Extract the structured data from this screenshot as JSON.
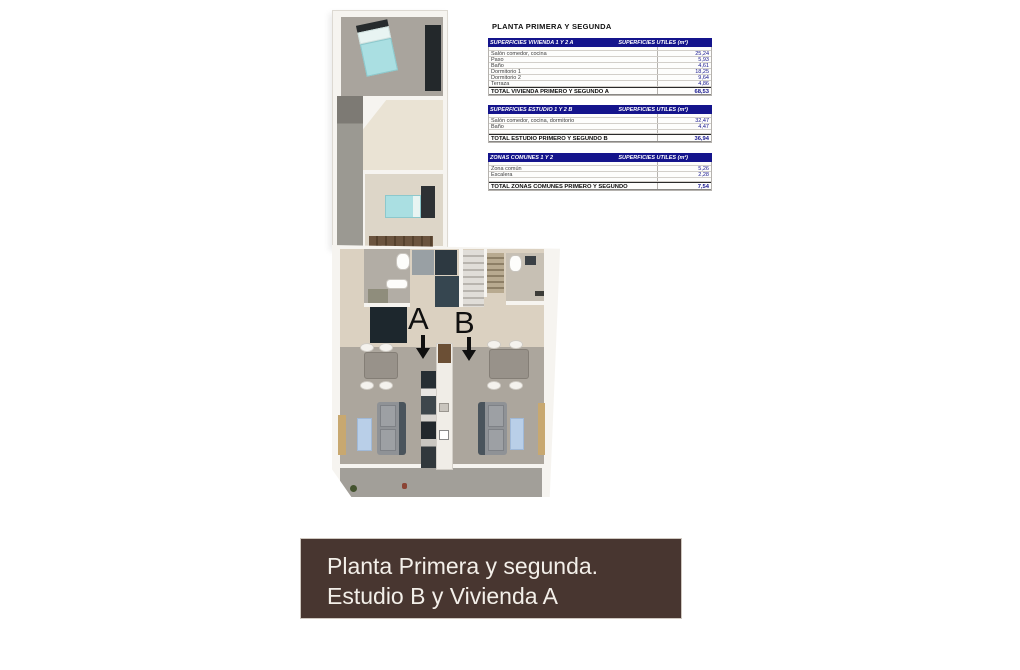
{
  "title": "PLANTA PRIMERA Y SEGUNDA",
  "tables": [
    {
      "header_left": "SUPERFICIES VIVIENDA 1 Y 2 A",
      "header_right": "SUPERFICIES UTILES  (m²)",
      "rows": [
        {
          "label": "Salón comedor, cocina",
          "value": "25,24"
        },
        {
          "label": "Paso",
          "value": "5,93"
        },
        {
          "label": "Baño",
          "value": "4,61"
        },
        {
          "label": "Dormitorio 1",
          "value": "18,25"
        },
        {
          "label": "Dormitorio 2",
          "value": "9,64"
        },
        {
          "label": "Terraza",
          "value": "4,86"
        }
      ],
      "total_label": "TOTAL VIVIENDA PRIMERO Y SEGUNDO A",
      "total_value": "68,53"
    },
    {
      "header_left": "SUPERFICIES ESTUDIO 1 Y 2 B",
      "header_right": "SUPERFICIES UTILES  (m²)",
      "rows": [
        {
          "label": "Salón comedor, cocina, dormitorio",
          "value": "32,47"
        },
        {
          "label": "Baño",
          "value": "4,47"
        }
      ],
      "total_label": "TOTAL ESTUDIO PRIMERO Y SEGUNDO B",
      "total_value": "36,94"
    },
    {
      "header_left": "ZONAS COMUNES 1 Y 2",
      "header_right": "SUPERFICIES UTILES  (m²)",
      "rows": [
        {
          "label": "Zona común",
          "value": "5,26"
        },
        {
          "label": "Escalera",
          "value": "2,28"
        }
      ],
      "total_label": "TOTAL ZONAS COMUNES PRIMERO Y SEGUNDO",
      "total_value": "7,54"
    }
  ],
  "plan": {
    "unit_a_label": "A",
    "unit_b_label": "B"
  },
  "banner": {
    "line1": "Planta Primera y segunda.",
    "line2": "Estudio B y Vivienda A"
  },
  "colors": {
    "table_header": "#14148c",
    "value_text": "#14148c",
    "banner_brown": "#483630",
    "bed_teal": "#aadfe2",
    "rug_blue": "#b9cfe8",
    "floor_gray": "#aca69d",
    "floor_beige": "#dbd1c1"
  }
}
